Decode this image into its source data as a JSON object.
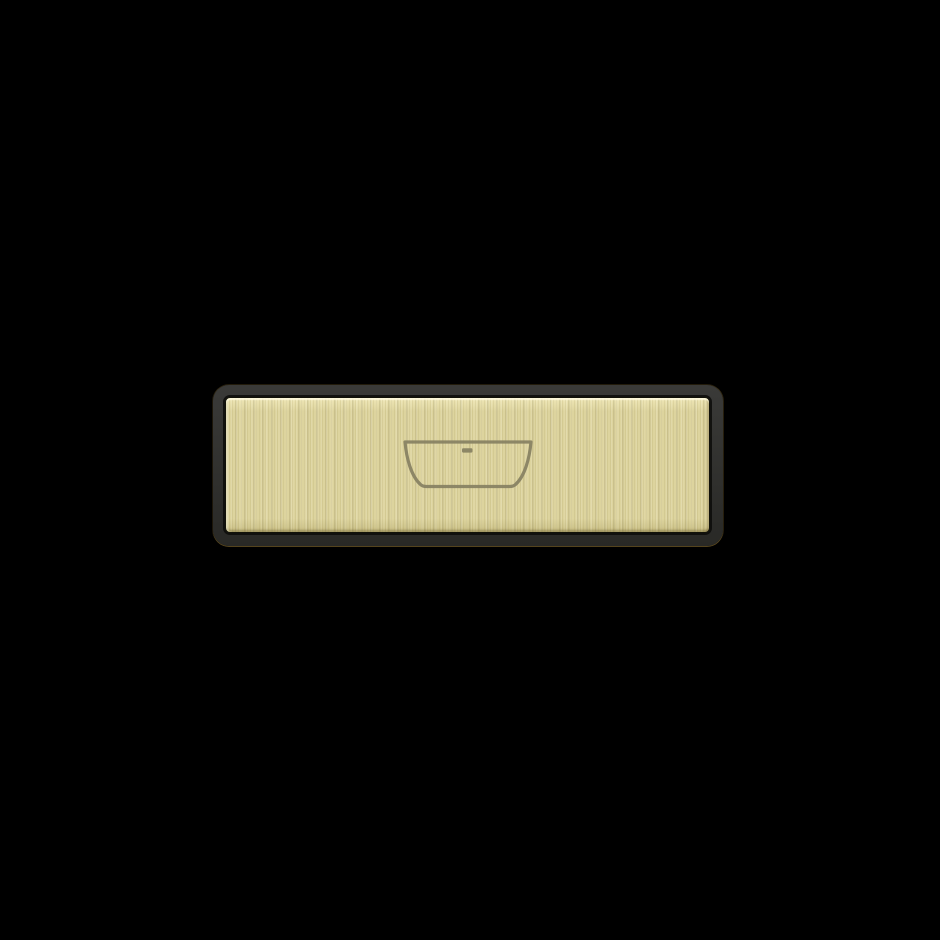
{
  "scene": {
    "object": "bathtub-sign-plaque",
    "icon": "bathtub-icon"
  },
  "colors": {
    "background": "#000000",
    "frame_top": "#3a3a38",
    "frame_bottom": "#292926",
    "frame_rim_gold": "#9a7c34",
    "plate_base": "#ddd49e",
    "plate_streak_light": "#efe7b6",
    "plate_streak_dark": "#c9bf85",
    "plate_gap": "#121209",
    "icon_stroke": "#878162"
  }
}
